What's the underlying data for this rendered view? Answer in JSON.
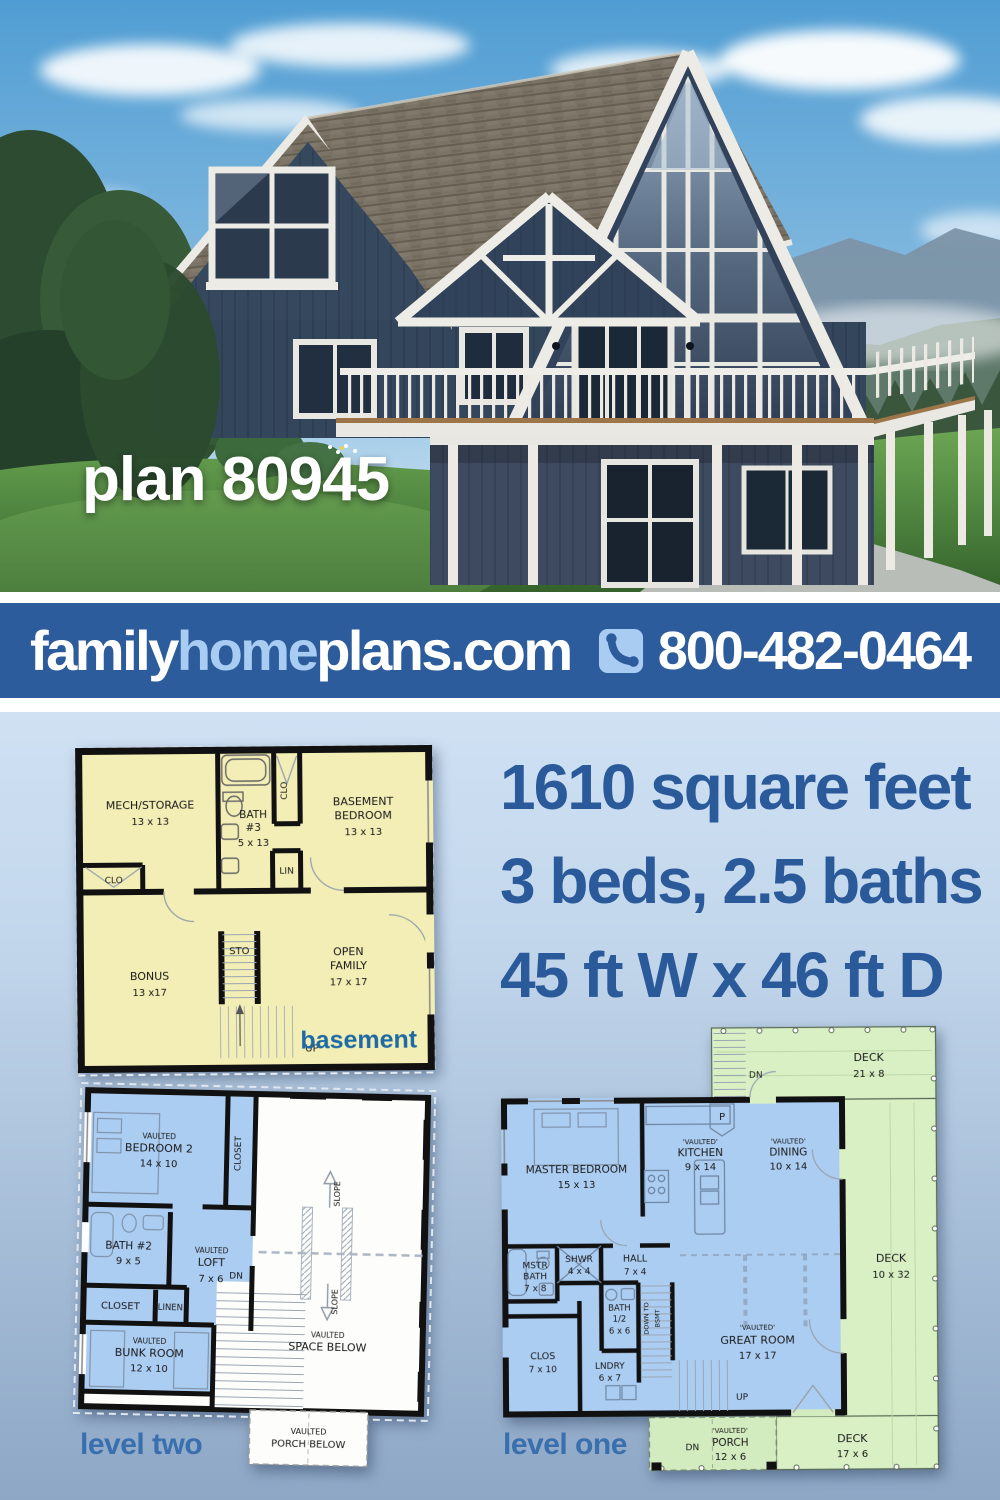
{
  "hero": {
    "plan_label": "plan 80945"
  },
  "banner": {
    "brand": {
      "part1": "family",
      "part2": "home",
      "part3": "plans.com"
    },
    "phone": "800-482-0464",
    "phone_icon": "phone-handset",
    "colors": {
      "background": "#2d5c9c",
      "brand_light": "#a9cdf2",
      "text": "#ffffff"
    }
  },
  "stats": {
    "line1": "1610 square feet",
    "line2": "3 beds, 2.5 baths",
    "line3": "45 ft W x 46 ft D",
    "color": "#2b5a9b"
  },
  "basement": {
    "plan_label": "basement",
    "colors": {
      "fill": "#f3eeb5",
      "label": "#1c6aa6"
    },
    "rooms": {
      "mech": {
        "name": "MECH/STORAGE",
        "dims": "13 x 13"
      },
      "bath3": {
        "l1": "BATH",
        "l2": "#3",
        "dims": "5 x 13"
      },
      "bedroom": {
        "l1": "BASEMENT",
        "l2": "BEDROOM",
        "dims": "13 x 13"
      },
      "bonus": {
        "name": "BONUS",
        "dims": "13 x17"
      },
      "family": {
        "l1": "OPEN",
        "l2": "FAMILY",
        "dims": "17 x 17"
      }
    },
    "labels": {
      "clo_top": "CLO",
      "clo_left": "CLO",
      "lin": "LIN",
      "sto": "STO",
      "up": "UP"
    }
  },
  "level_two": {
    "plan_label": "level two",
    "colors": {
      "room_fill": "#accdf2"
    },
    "rooms": {
      "bedroom2": {
        "l1": "VAULTED",
        "l2": "BEDROOM 2",
        "dims": "14 x 10"
      },
      "closet_top": "CLOSET",
      "bath2": {
        "name": "BATH #2",
        "dims": "9 x 5"
      },
      "loft": {
        "l1": "VAULTED",
        "l2": "LOFT",
        "dims": "7 x 6"
      },
      "closet": "CLOSET",
      "linen": "LINEN",
      "bunk": {
        "l1": "VAULTED",
        "l2": "BUNK ROOM",
        "dims": "12 x 10"
      },
      "space_below": {
        "l1": "VAULTED",
        "l2": "SPACE BELOW"
      },
      "porch_below": {
        "l1": "VAULTED",
        "l2": "PORCH BELOW"
      }
    },
    "labels": {
      "dn": "DN",
      "slope_up": "SLOPE",
      "slope_down": "SLOPE"
    }
  },
  "level_one": {
    "plan_label": "level one",
    "colors": {
      "room_fill": "#accdf2",
      "deck_fill": "#d9efc4"
    },
    "rooms": {
      "master": {
        "name": "MASTER BEDROOM",
        "dims": "15 x 13"
      },
      "kitchen": {
        "l1": "'VAULTED'",
        "l2": "KITCHEN",
        "dims": "9 x 14"
      },
      "dining": {
        "l1": "'VAULTED'",
        "l2": "DINING",
        "dims": "10 x 14"
      },
      "pantry": "P",
      "shwr": {
        "name": "SHWR",
        "dims": "4 x 4"
      },
      "hall": {
        "name": "HALL",
        "dims": "7 x 4"
      },
      "mstr_bath": {
        "l1": "MSTR",
        "l2": "BATH",
        "dims": "7 x 8"
      },
      "half_bath": {
        "l1": "BATH",
        "l2": "1/2",
        "dims": "6 x 6"
      },
      "clos": {
        "name": "CLOS",
        "dims": "7 x 10"
      },
      "lndry": {
        "name": "LNDRY",
        "dims": "6 x 7"
      },
      "great": {
        "l1": "'VAULTED'",
        "l2": "GREAT ROOM",
        "dims": "17 x 17"
      },
      "stairs_down": {
        "l1": "DOWN TO",
        "l2": "BSMT"
      },
      "deck_top": {
        "name": "DECK",
        "dims": "21 x 8"
      },
      "deck_right": {
        "name": "DECK",
        "dims": "10 x 32"
      },
      "deck_bottom": {
        "name": "DECK",
        "dims": "17 x 6"
      },
      "porch": {
        "l1": "'VAULTED'",
        "l2": "PORCH",
        "dims": "12 x 6"
      }
    },
    "labels": {
      "dn_top": "DN",
      "dn_bottom": "DN",
      "up": "UP"
    }
  }
}
